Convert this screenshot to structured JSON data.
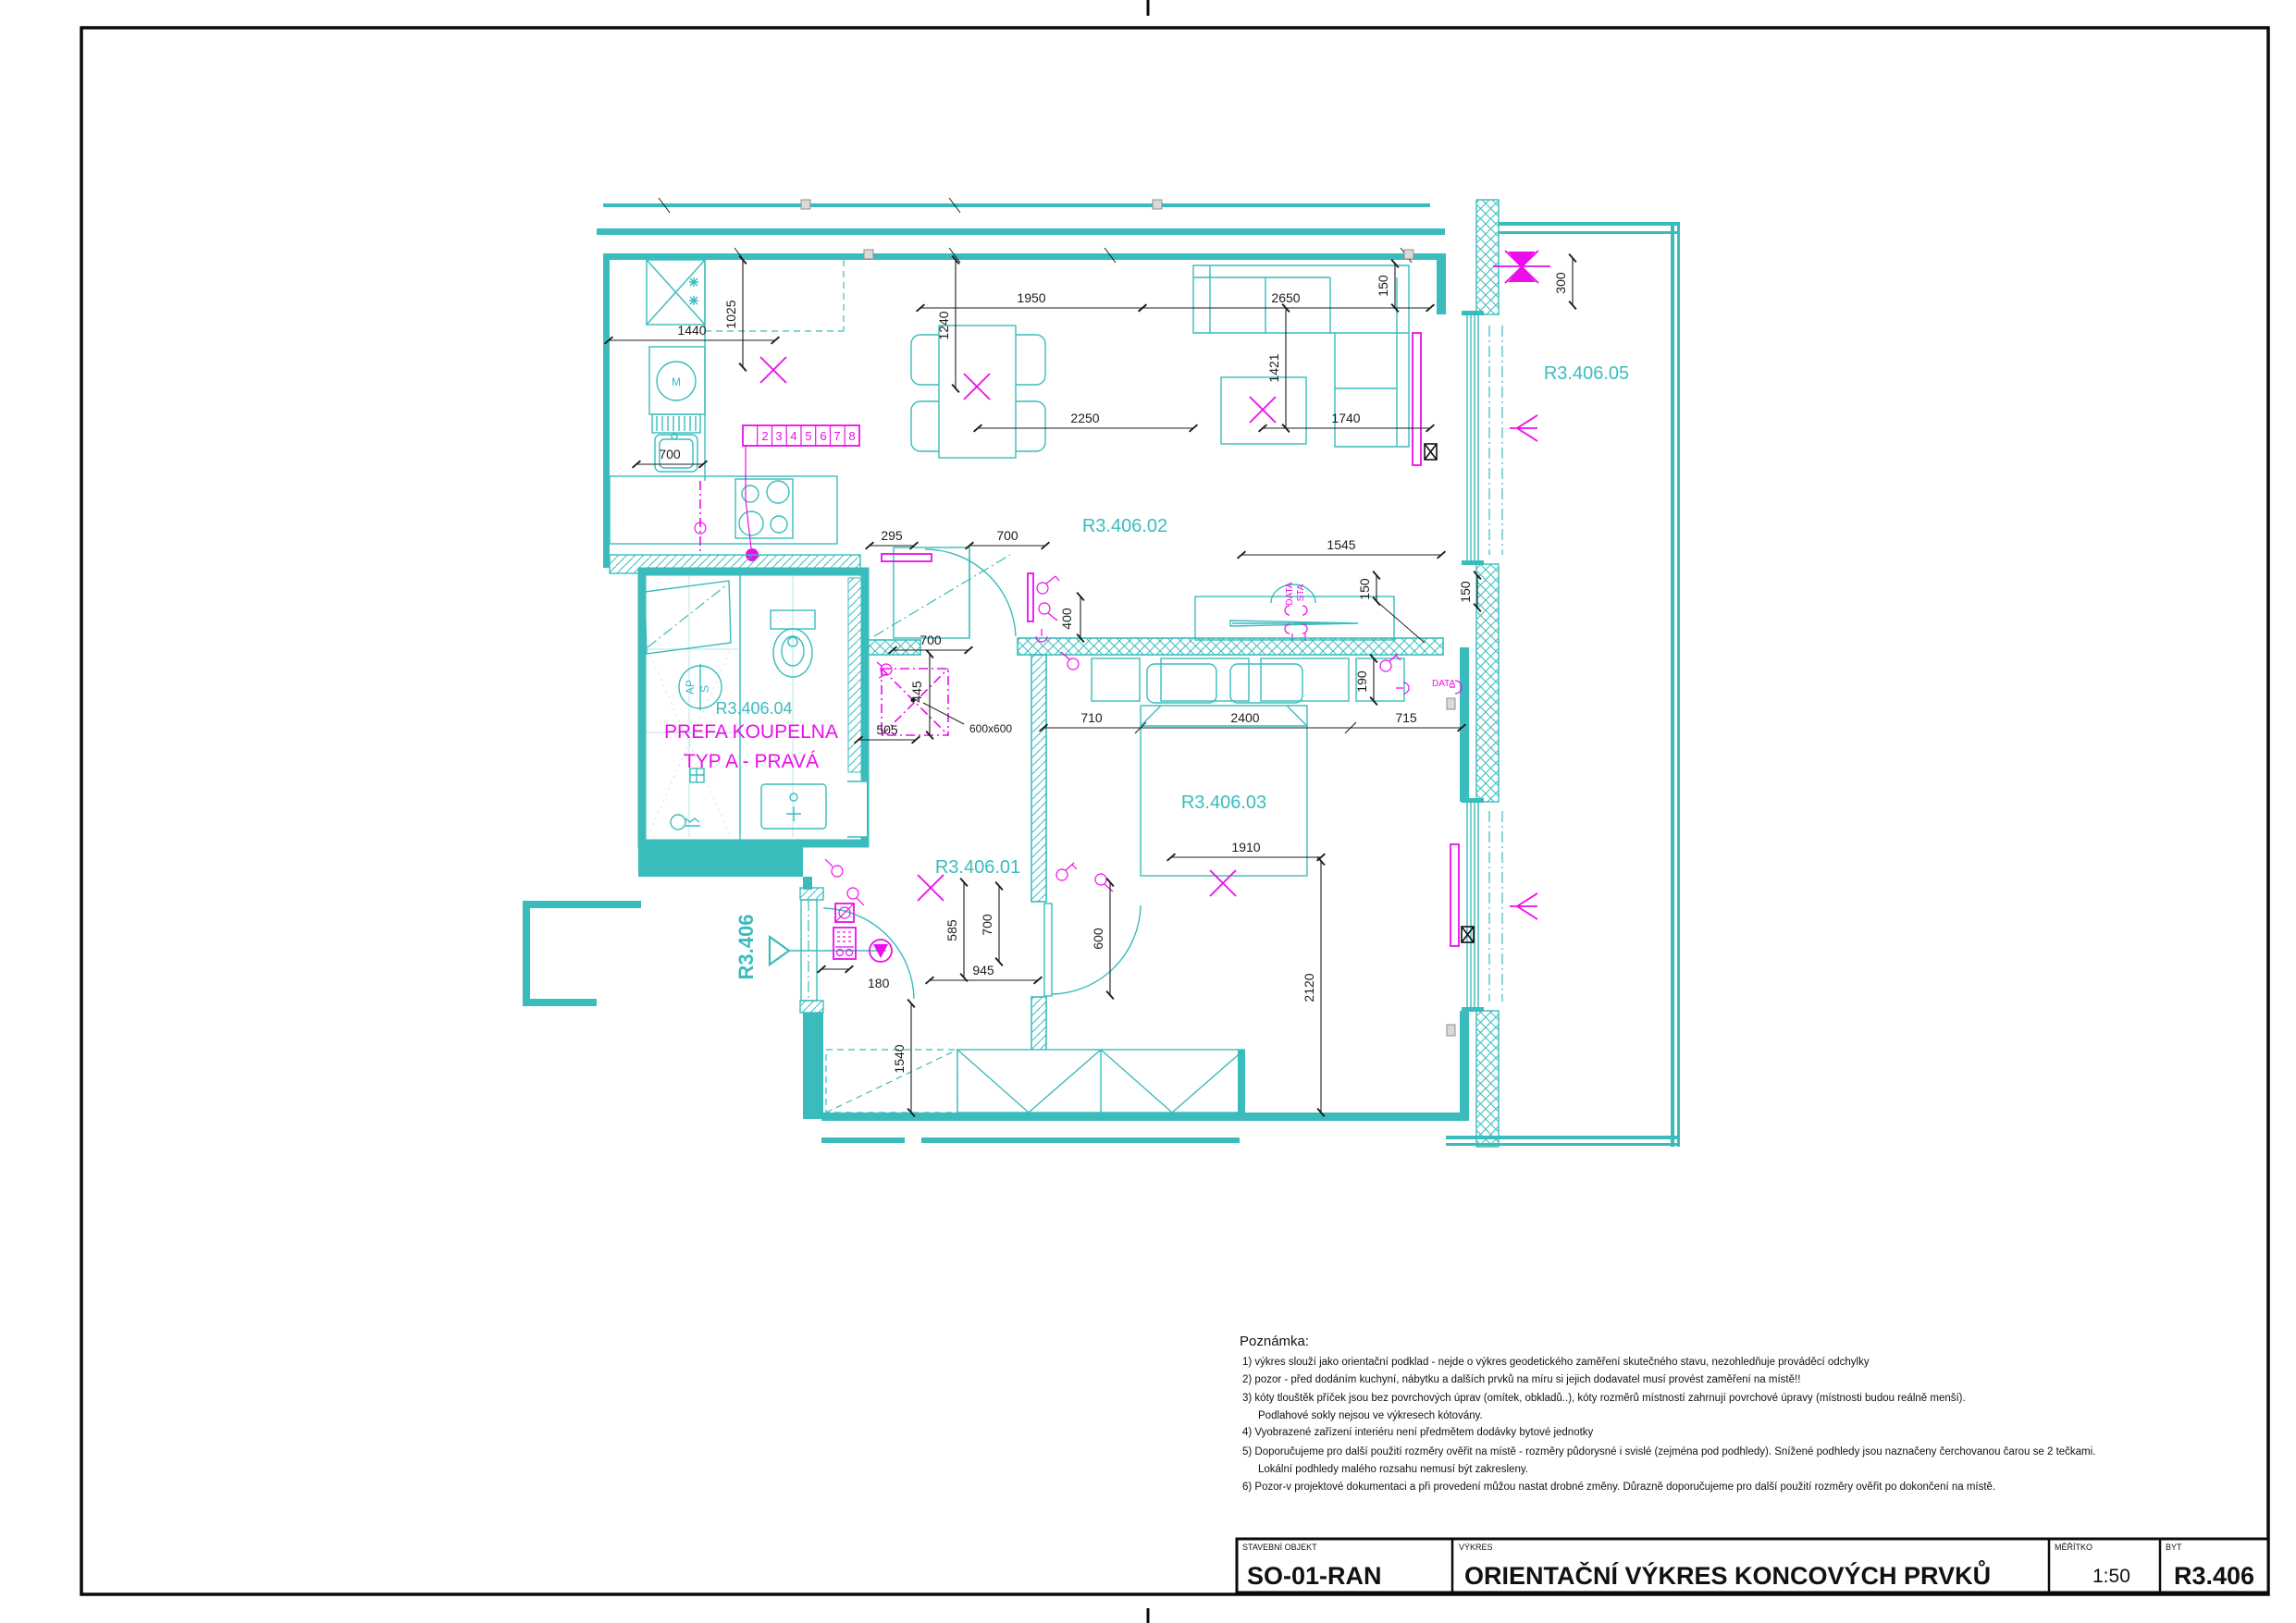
{
  "title_block": {
    "fields": [
      {
        "label": "STAVEBNÍ OBJEKT",
        "value": "SO-01-RAN"
      },
      {
        "label": "VÝKRES",
        "value": "ORIENTAČNÍ VÝKRES KONCOVÝCH PRVKŮ"
      },
      {
        "label": "MĚŘÍTKO",
        "value": "1:50"
      },
      {
        "label": "BYT",
        "value": "R3.406"
      }
    ]
  },
  "notes": {
    "heading": "Poznámka:",
    "lines": [
      "1)  výkres slouží jako orientační podklad - nejde o výkres geodetického zaměření skutečného stavu, nezohledňuje prováděcí odchylky",
      "2)  pozor - před dodáním kuchyní, nábytku a  dalších prvků na míru si jejich dodavatel musí provést zaměření na místě!!",
      "3)  kóty tlouštěk příček jsou bez povrchových úprav (omítek, obkladů..), kóty rozměrů místností zahrnují povrchové úpravy (místnosti budou reálně menší).",
      "Podlahové sokly nejsou ve výkresech kótovány.",
      "4)  Vyobrazené zařízení interiéru není předmětem dodávky bytové jednotky",
      "5)  Doporučujeme pro další použití rozměry ověřit na místě - rozměry půdorysné i svislé (zejména pod podhledy). Snížené podhledy jsou naznačeny čerchovanou čarou se 2 tečkami.",
      "Lokální podhledy malého rozsahu nemusí být zakresleny.",
      "6)  Pozor-v projektové dokumentaci a při provedení můžou nastat drobné změny. Důrazně doporučujeme pro další použití rozměry ověřit po dokončení na místě."
    ]
  },
  "rooms": {
    "hall": "R3.406.01",
    "living": "R3.406.02",
    "bedroom": "R3.406.03",
    "bathroom": "R3.406.04",
    "balcony": "R3.406.05",
    "entry": "R3.406",
    "prefab_line1": "PREFA KOUPELNA",
    "prefab_line2": "TYP A - PRAVÁ"
  },
  "fixtures": {
    "machine": "M",
    "washer_ap": "AP",
    "washer_s": "S"
  },
  "electro": {
    "strip": [
      "2",
      "3",
      "4",
      "5",
      "6",
      "7",
      "8"
    ],
    "data": "DATA",
    "sta": "STA",
    "data_outlet": "DATA",
    "hatch_size": "600x600"
  },
  "dims": [
    "1440",
    "1025",
    "700",
    "1950",
    "1240",
    "2250",
    "2650",
    "1421",
    "150",
    "1740",
    "300",
    "295",
    "700",
    "400",
    "1545",
    "150",
    "700",
    "445",
    "505",
    "710",
    "2400",
    "715",
    "190",
    "1910",
    "2120",
    "600",
    "585",
    "700",
    "945",
    "180",
    "1540",
    "150"
  ],
  "colors": {
    "wall": "#3ABCBD",
    "electro": "#EB0EEB",
    "dimension": "#1C1C1C"
  }
}
